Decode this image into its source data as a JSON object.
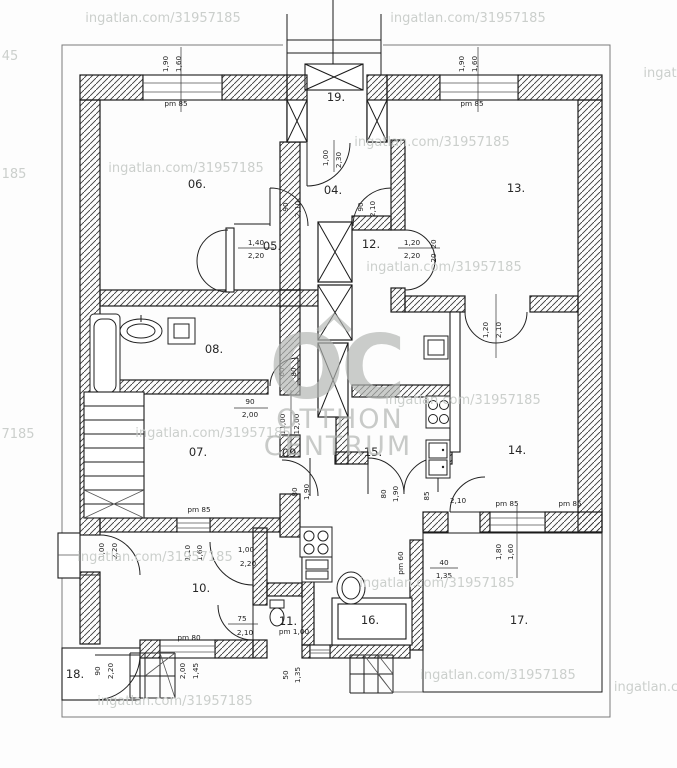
{
  "watermark": {
    "site_url_text": "ingatlan.com/31957185",
    "fragments": {
      "f1": "45",
      "f2": "185",
      "f3": "7185",
      "f4": "ingat",
      "f5": "ingatlan.co"
    },
    "logo": {
      "initials": "OC",
      "line1": "OTTHON",
      "line2": "CENTRUM"
    }
  },
  "rooms": [
    {
      "label": "06."
    },
    {
      "label": "19."
    },
    {
      "label": "04."
    },
    {
      "label": "13."
    },
    {
      "label": "05."
    },
    {
      "label": "12."
    },
    {
      "label": "08."
    },
    {
      "label": "07."
    },
    {
      "label": "09."
    },
    {
      "label": "15."
    },
    {
      "label": "14."
    },
    {
      "label": "10."
    },
    {
      "label": "11."
    },
    {
      "label": "16."
    },
    {
      "label": "17."
    },
    {
      "label": "18."
    }
  ],
  "dims": [
    "1,90",
    "1,60",
    "pm 85",
    "1,90",
    "1,60",
    "pm 85",
    "1,00",
    "2,30",
    "90",
    "2,10",
    "90",
    "2,10",
    "1,40",
    "2,20",
    "1,20",
    "2,20",
    "20",
    "20",
    "1,20",
    "2,10",
    "60",
    "80",
    "90",
    "2,00",
    "11,00",
    "12,00",
    "pm 85",
    "1,10",
    "1,60",
    "1,00",
    "2,20",
    "1,00",
    "2,20",
    "75",
    "2,10",
    "pm 80",
    "pm 1,00",
    "90",
    "2,20",
    "2,00",
    "1,45",
    "50",
    "1,35",
    "80",
    "1,90",
    "80",
    "1,90",
    "85",
    "2,10",
    "pm 85",
    "pm 85",
    "1,80",
    "1,60",
    "pm 60",
    "40",
    "1,35"
  ]
}
